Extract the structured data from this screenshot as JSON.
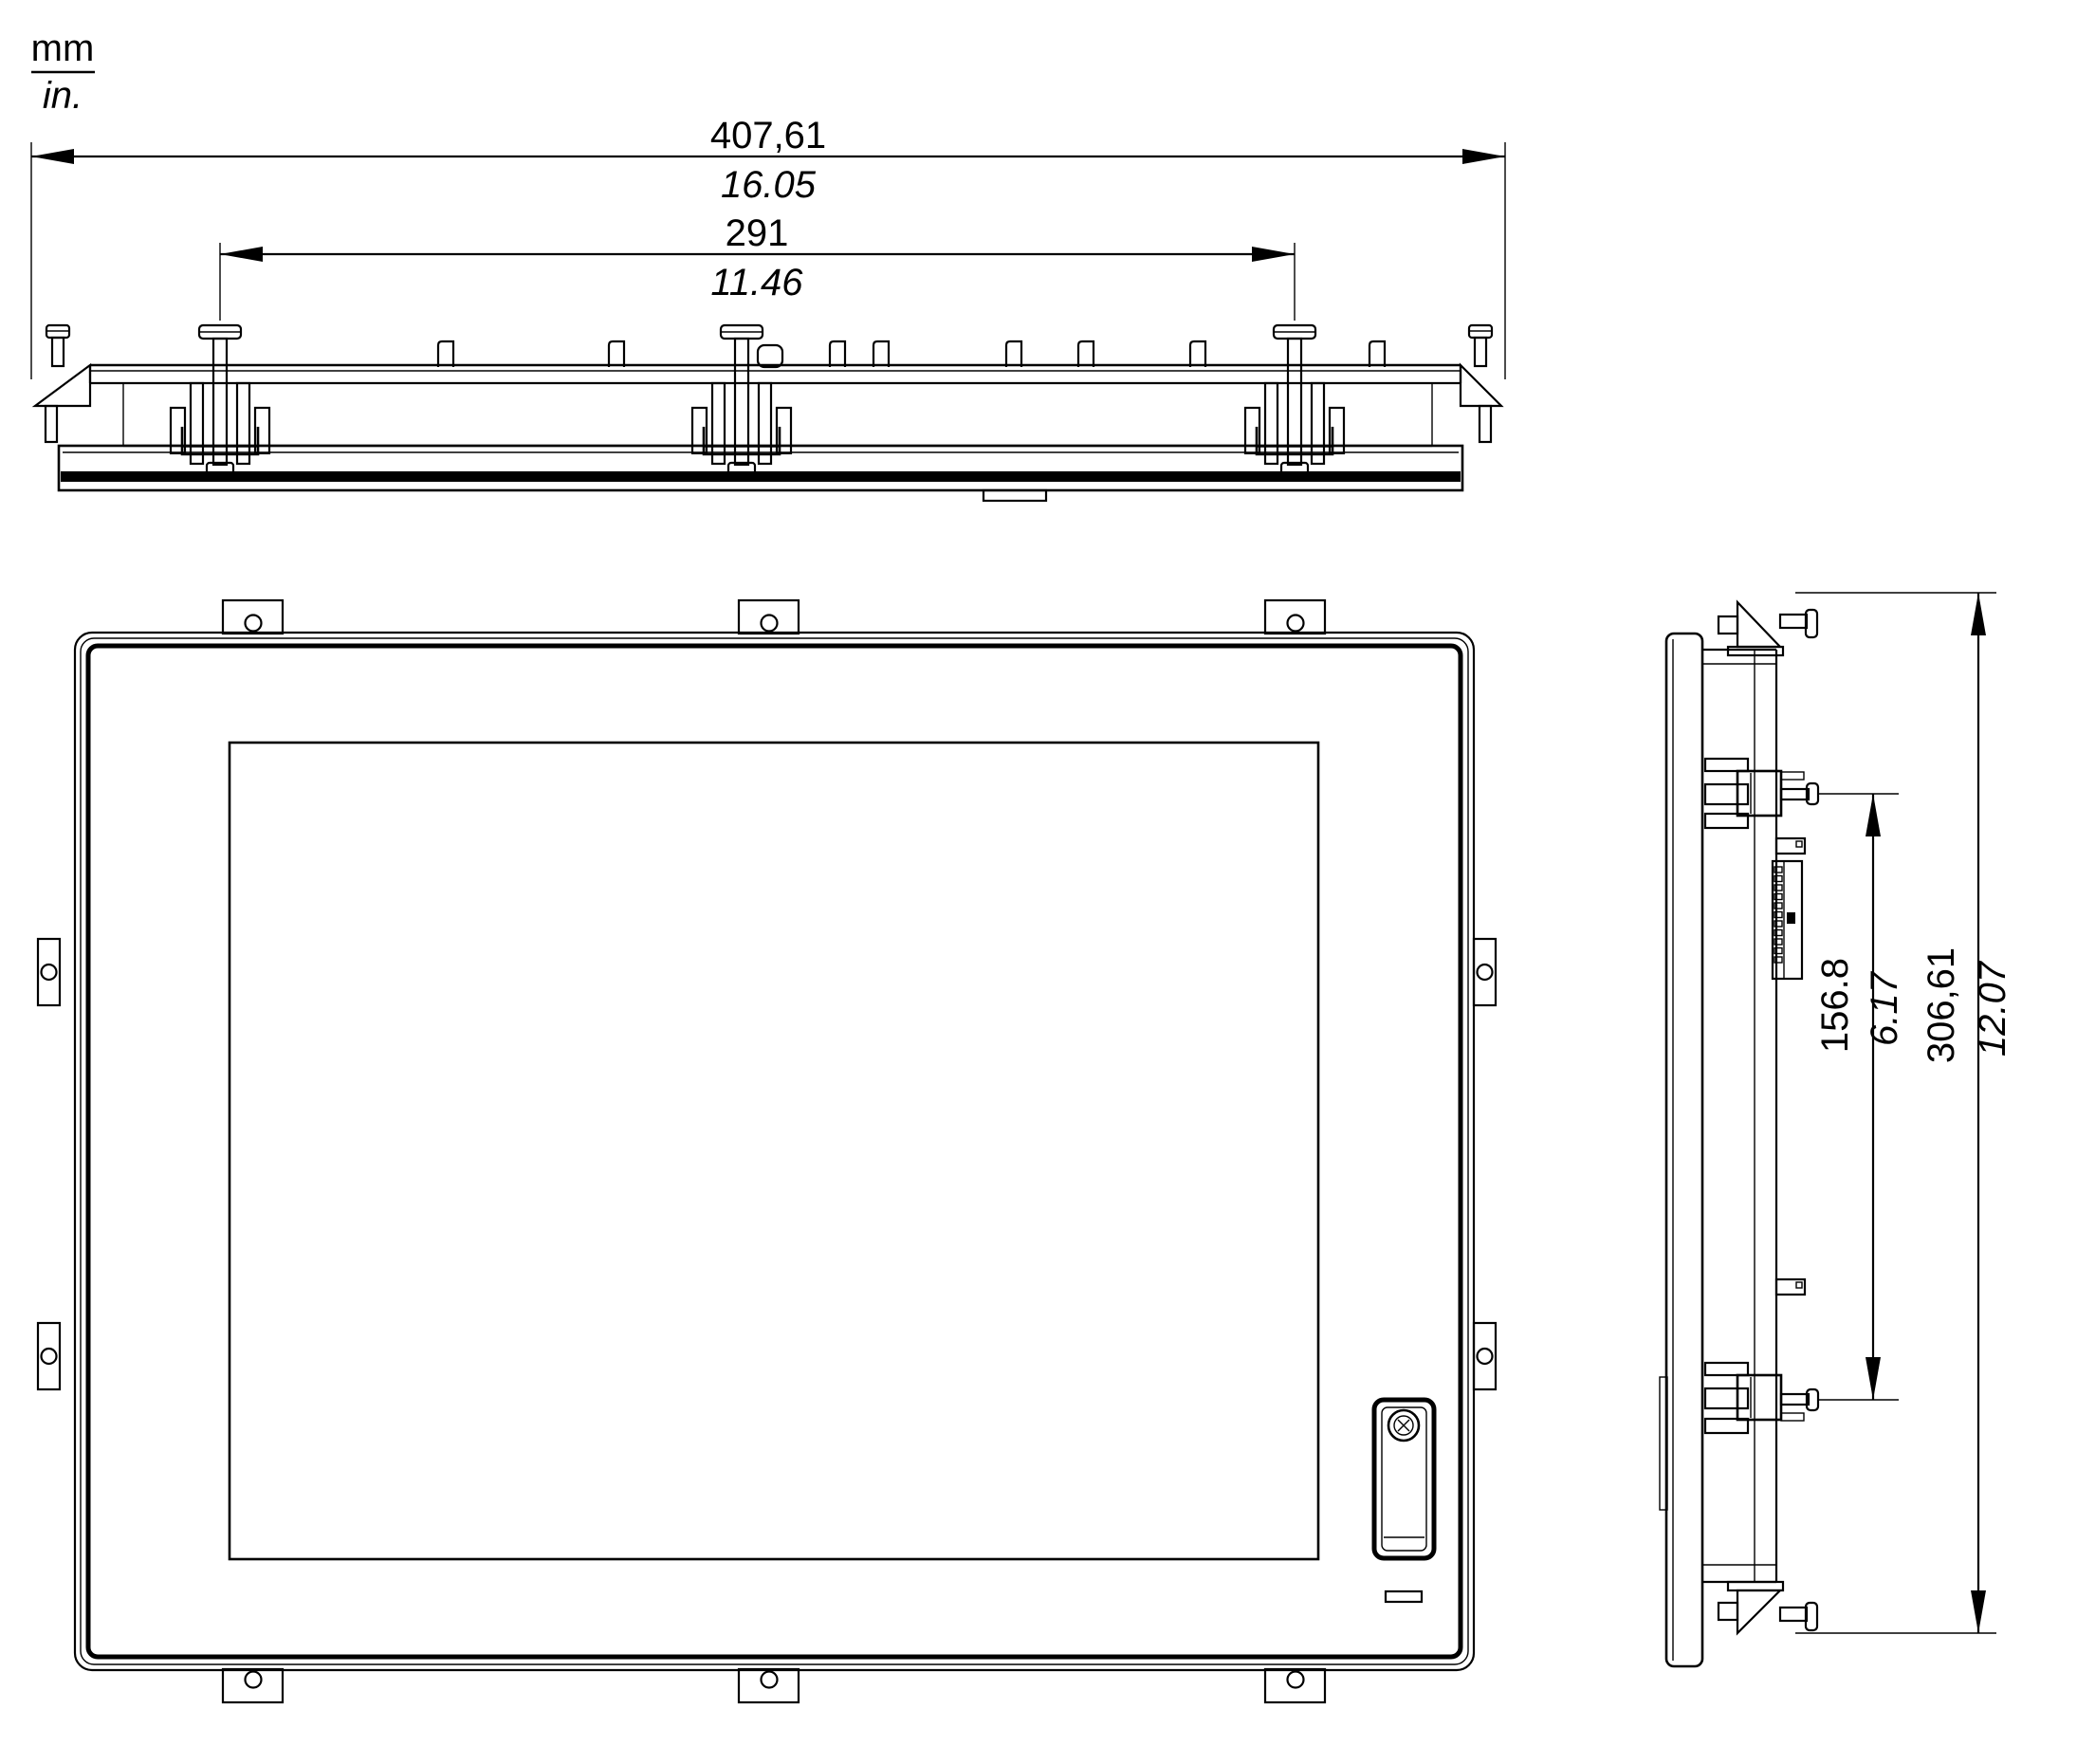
{
  "drawing": {
    "unit_legend": {
      "numerator": "mm",
      "denominator": "in."
    },
    "dimensions": {
      "overall_width": {
        "mm": "407,61",
        "in": "16.05"
      },
      "mounting_width": {
        "mm": "291",
        "in": "11.46"
      },
      "overall_height": {
        "mm": "306,61",
        "in": "12.07"
      },
      "mounting_height": {
        "mm": "156.8",
        "in": "6.17"
      }
    },
    "colors": {
      "line": "#000000",
      "background": "#ffffff"
    }
  }
}
